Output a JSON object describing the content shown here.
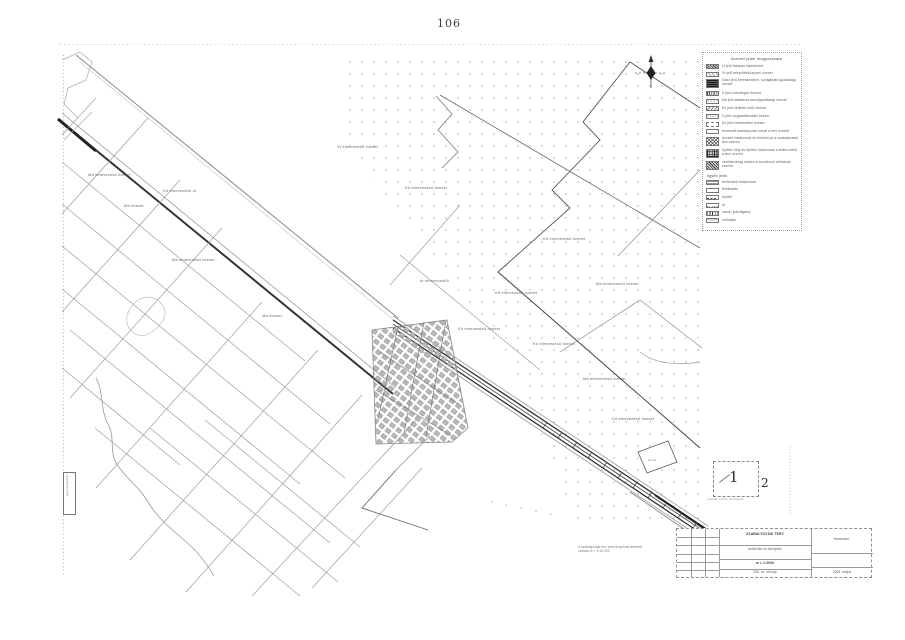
{
  "page": {
    "number": "106"
  },
  "map_labels": {
    "band_road": "Kö elnevezésű út",
    "items": [
      "Má elnevezésű övezet",
      "Má övezet",
      "Má elnevezésű övezet",
      "Vt elnevezésű övezet",
      "Kö elnevezésű övezet",
      "Kö elnevezésű övezet",
      "Má elnevezésű övezet",
      "Kö elnevezésű övezet",
      "Kö elnevezésű övezet",
      "Kö elnevezésű övezet",
      "Má elnevezésű övezet",
      "Kö elnevezésű övezet",
      "út elnevezéstől",
      "Kö öv.",
      "Má övezet"
    ]
  },
  "legend": {
    "title": "övezeti jelek magyarázata",
    "groups": [
      {
        "items": [
          {
            "label": "Lf jelű falusias lakóövezet"
          },
          {
            "label": "Vt jelű településközponti övezet"
          },
          {
            "label": "Gksz jelű kereskedelmi, szolgáltató gazdasági övezet"
          },
          {
            "label": "K jelű különleges övezet"
          },
          {
            "label": "Má jelű általános mezőgazdasági övezet"
          },
          {
            "label": "Ev jelű védelmi erdő övezet"
          },
          {
            "label": "V jelű vízgazdálkodási övezet"
          },
          {
            "label": "Kö jelű közlekedési övezet"
          },
          {
            "label": "tervezett szabályozási vonal a terv szerint"
          },
          {
            "label": "övezeti határvonal és övezeti jel a szabályozási terv szerint"
          },
          {
            "label": "építési hely és építési határvonal a telken belül a terv szerint"
          },
          {
            "label": "védőtávolság határa a vonatkozó előírások szerint"
          }
        ]
      },
      {
        "title": "egyéb jelek",
        "items": [
          {
            "label": "belterületi határvonal"
          },
          {
            "label": "telekhatár"
          },
          {
            "label": "épület"
          },
          {
            "label": "út"
          },
          {
            "label": "vasút, iparvágány"
          },
          {
            "label": "vízfolyás"
          }
        ]
      }
    ]
  },
  "inset": {
    "sheet1": "1",
    "sheet2": "2",
    "caption": "szabályozási tervlapok"
  },
  "title_block": {
    "caption_line1": "a szabályozási terv szelvényeinek átnézeti",
    "caption_line2": "vázlata  m = 1:16 000",
    "header": "SZABÁLYOZÁSI TERV",
    "sub1": "belterület és környéke",
    "sub2": "m = 1:2000",
    "sub3": "106. sz. tervlap",
    "right_top": "törzsszám:",
    "right_bottom": "2005. május"
  },
  "margin": {
    "left_label": "szelvényhatár"
  }
}
